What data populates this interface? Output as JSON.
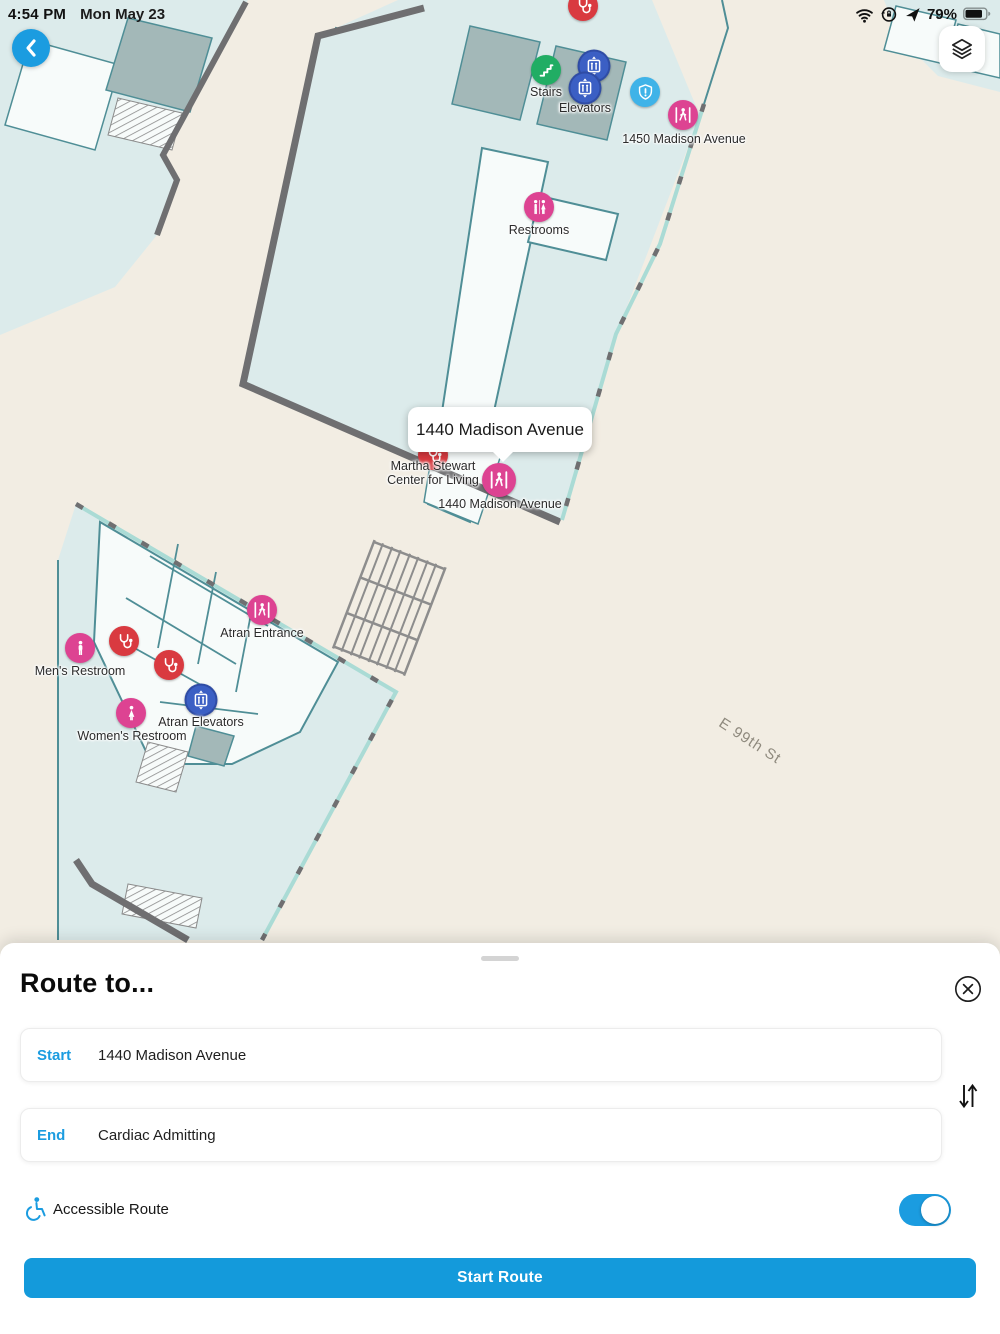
{
  "status_bar": {
    "time": "4:54 PM",
    "date": "Mon May 23",
    "battery_percent": "79%",
    "icons": [
      "wifi-icon",
      "orientation-lock-icon",
      "location-arrow-icon",
      "battery-icon"
    ]
  },
  "map": {
    "callout": {
      "text": "1440 Madison Avenue"
    },
    "street_label": "E 99th St",
    "labels": {
      "stairs": "Stairs",
      "elevators": "Elevators",
      "entrance_1450": "1450 Madison Avenue",
      "restrooms": "Restrooms",
      "martha_line1": "Martha Stewart",
      "martha_line2": "Center for Living",
      "entrance_1440": "1440 Madison Avenue",
      "atran_entrance": "Atran Entrance",
      "mens_restroom": "Men's Restroom",
      "atran_elevators": "Atran Elevators",
      "womens_restroom": "Women's Restroom"
    },
    "marker_types": {
      "pink": "entrance / restroom",
      "red": "medical-stethoscope",
      "green": "stairs",
      "blue": "elevator",
      "cyan": "security-shield"
    }
  },
  "route_panel": {
    "title": "Route to...",
    "start_label": "Start",
    "start_value": "1440 Madison Avenue",
    "end_label": "End",
    "end_value": "Cardiac Admitting",
    "accessible_label": "Accessible Route",
    "accessible_enabled": true,
    "start_route_button": "Start Route"
  },
  "colors": {
    "accent": "#1b9ce0",
    "button_blue": "#149adb",
    "marker_pink": "#dd4392",
    "marker_red": "#d93a40",
    "marker_green": "#21ad64",
    "marker_elevator_blue": "#3b5fc4",
    "marker_security_cyan": "#3fb3e8",
    "map_background": "#f2ede3",
    "building_fill": "#dcebeb"
  }
}
